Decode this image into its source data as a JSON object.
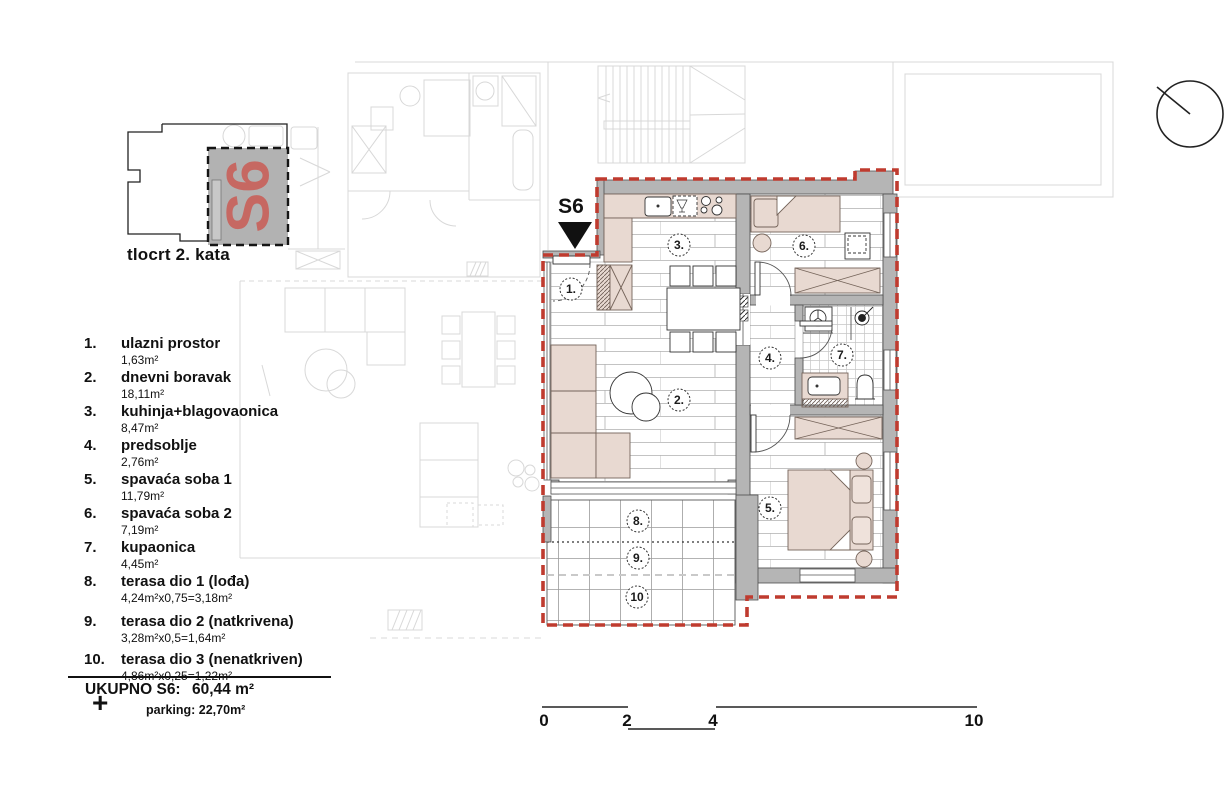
{
  "key_plan": {
    "unit_label": "S6",
    "caption": "tlocrt 2. kata"
  },
  "plan": {
    "unit_marker": "S6",
    "room_labels": [
      "1.",
      "2.",
      "3.",
      "4.",
      "5.",
      "6.",
      "7.",
      "8.",
      "9.",
      "10"
    ]
  },
  "legend": {
    "items": [
      {
        "num": "1.",
        "name": "ulazni prostor",
        "area": "1,63m²"
      },
      {
        "num": "2.",
        "name": "dnevni boravak",
        "area": "18,11m²"
      },
      {
        "num": "3.",
        "name": "kuhinja+blagovaonica",
        "area": "8,47m²"
      },
      {
        "num": "4.",
        "name": "predsoblje",
        "area": "2,76m²"
      },
      {
        "num": "5.",
        "name": "spavaća soba 1",
        "area": "11,79m²"
      },
      {
        "num": "6.",
        "name": "spavaća soba 2",
        "area": "7,19m²"
      },
      {
        "num": "7.",
        "name": "kupaonica",
        "area": "4,45m²"
      },
      {
        "num": "8.",
        "name": "terasa dio 1 (lođa)",
        "area": "4,24m²x0,75=3,18m²"
      },
      {
        "num": "9.",
        "name": "terasa dio 2 (natkrivena)",
        "area": "3,28m²x0,5=1,64m²"
      },
      {
        "num": "10.",
        "name": "terasa dio 3 (nenatkriven)",
        "area": "4,86m²x0,25=1,22m²"
      }
    ]
  },
  "summary": {
    "total_label": "UKUPNO S6:",
    "total_value": "60,44 m²",
    "plus": "+",
    "parking": "parking: 22,70m²"
  },
  "scale_bar": {
    "labels": [
      "0",
      "2",
      "4",
      "10"
    ]
  },
  "colors": {
    "boundary_red": "#bf3b2f",
    "wall_gray": "#b5b5b5",
    "furniture_pink": "#e8d9d1",
    "unit_label_red": "#c9605a",
    "faint_line": "#d8d8d8"
  }
}
